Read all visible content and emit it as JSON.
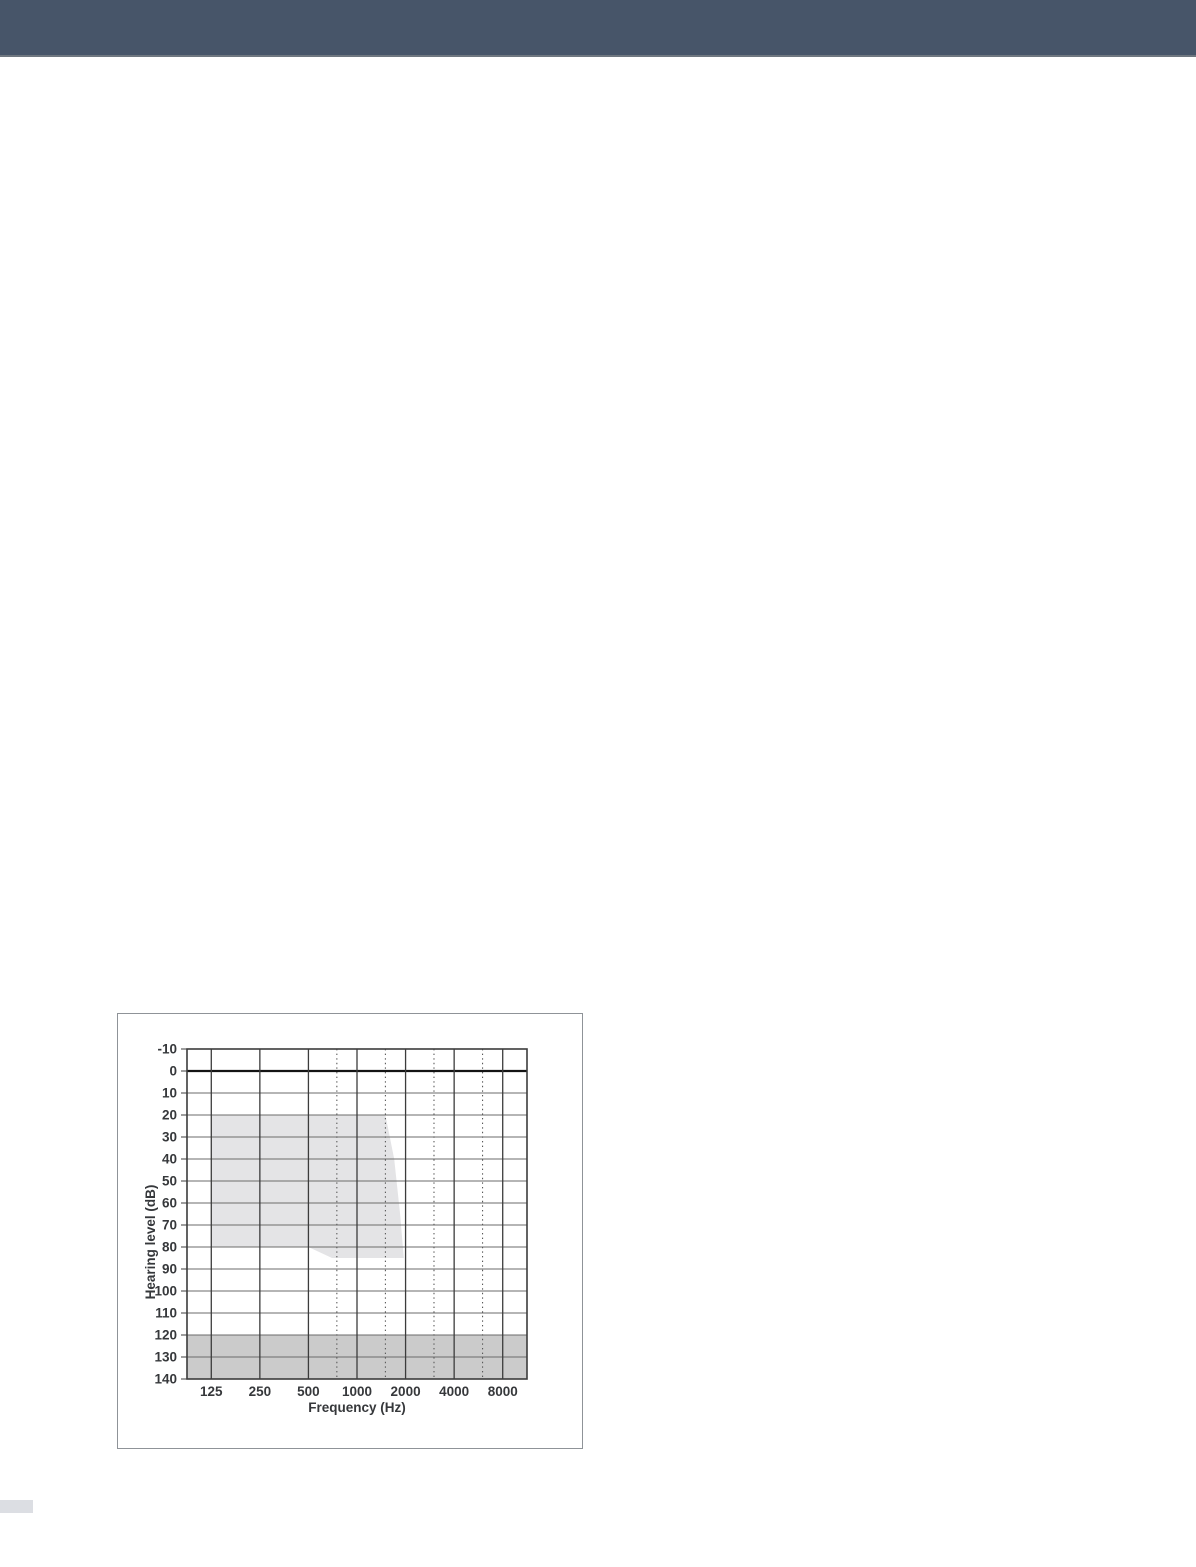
{
  "page": {
    "background": "#ffffff"
  },
  "header": {
    "background": "#475569",
    "border_color": "#6f7780",
    "height_px": 55
  },
  "footer_fragment": {
    "background": "#dcdee3"
  },
  "chart_panel": {
    "border_color": "#8f9398",
    "background": "#ffffff"
  },
  "chart_data": {
    "type": "area",
    "title": "",
    "xlabel": "Frequency (Hz)",
    "ylabel": "Hearing level (dB)",
    "x_scale": "log2-octaves",
    "x_ticks": [
      125,
      250,
      500,
      1000,
      2000,
      4000,
      8000
    ],
    "x_tick_labels": [
      "125",
      "250",
      "500",
      "1000",
      "2000",
      "4000",
      "8000"
    ],
    "x_minor_dotted": [
      750,
      1500,
      3000,
      6000
    ],
    "xlim_octave_padding": 0.5,
    "y_ticks": [
      -10,
      0,
      10,
      20,
      30,
      40,
      50,
      60,
      70,
      80,
      90,
      100,
      110,
      120,
      130,
      140
    ],
    "ylim": [
      -10,
      140
    ],
    "emphasized_y_line": 0,
    "grid": true,
    "legend": "none",
    "fitting_range_polygon_hz_db": [
      [
        125,
        20
      ],
      [
        1500,
        20
      ],
      [
        1700,
        40
      ],
      [
        1850,
        65
      ],
      [
        1950,
        85
      ],
      [
        700,
        85
      ],
      [
        500,
        80
      ],
      [
        125,
        80
      ]
    ],
    "shaded_output_band_db": [
      120,
      140
    ],
    "colors": {
      "fitting_range_fill": "#e4e4e6",
      "output_band_fill": "#cbcbcb",
      "grid_horizontal": "#6b6b6b",
      "grid_vertical": "#3c3c3c",
      "grid_dotted": "#5a5a5a",
      "zero_line": "#141414",
      "plot_border": "#3c3c3c",
      "tick_label": "#36383b",
      "axis_title": "#36383b"
    }
  }
}
